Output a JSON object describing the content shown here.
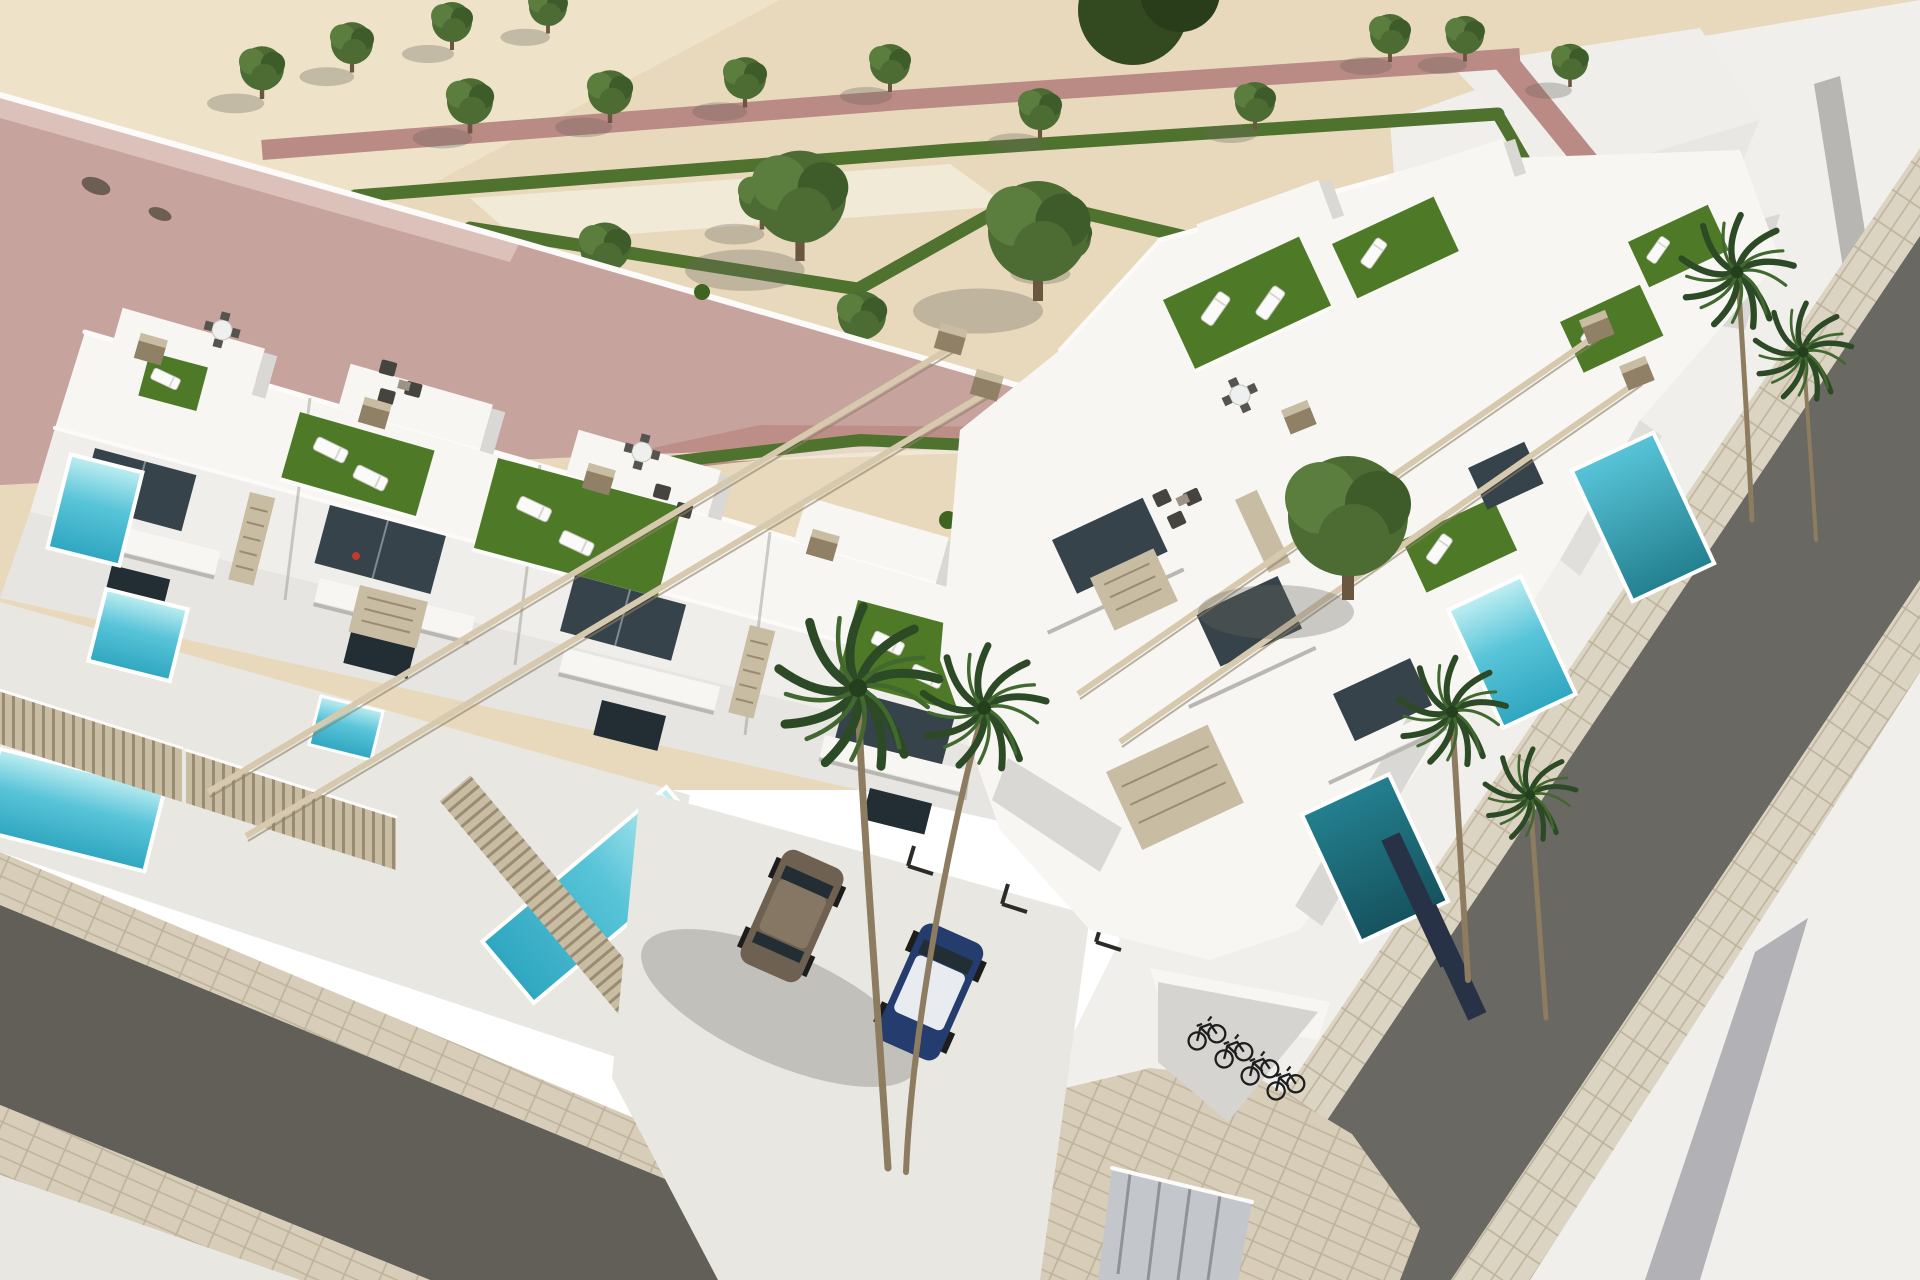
{
  "meta": {
    "type": "architectural-3d-render",
    "title": "Aerial render: modern white townhouse development on a corner plot with park, rooftop terraces and pools"
  },
  "palette": {
    "sand": "#e8d9bc",
    "sandLight": "#f3e9d2",
    "sandPath": "#f2ecdc",
    "plaza": "#f0efec",
    "concrete": "#e9e7e2",
    "roofPink": "#c7a39e",
    "roofPinkLight": "#dcc0ba",
    "pathPink": "#ba8a84",
    "hedge": "#50722f",
    "tree": "#4c6c34",
    "treeLight": "#5b7e3e",
    "treeDark": "#3e5c2a",
    "trunk": "#6b5640",
    "white": "#f7f6f3",
    "whiteDim": "#efeeea",
    "whiteShade": "#e7e5e1",
    "wallShadow": "#d9d8d4",
    "wallDark": "#c9c8c4",
    "parapet": "#fcfbf9",
    "edge": "#8a8984",
    "glass": "#37434a",
    "glassDark": "#232e34",
    "tan": "#c8bca3",
    "tanDark": "#9a8c72",
    "tanDeep": "#8f8066",
    "beam": "#d6c9ae",
    "beamShadow": "#8d8168",
    "turf": "#4e7a28",
    "turfDark": "#3f6420",
    "aquaLight": "#bfeef2",
    "aqua": "#58c4d8",
    "aquaDeep": "#2fa6c0",
    "teal": "#23808f",
    "tealDark": "#16525e",
    "asphalt": "#615f58",
    "asphaltRight": "#6a6862",
    "paver": "#d7cdb9",
    "paverLine": "#bdb29a",
    "stripe": "#a7a6ab",
    "carBronze": "#6e6151",
    "carBronzeTop": "#857764",
    "carBlue": "#243c6e",
    "carRoof": "#e8ecf0",
    "wheel": "#1d1d1d",
    "bike": "#1e1e1e",
    "shed": "#c3c6cb",
    "shedLine": "#8f9298",
    "darkFence": "#273246",
    "loungerFill": "#fafaf8",
    "loungerEdge": "#c6c4bf",
    "sofa": "#45443e",
    "chair": "#55544e",
    "tableTop": "#eef0f0",
    "palmDark": "#2c4a25",
    "palmLight": "#41682f",
    "palmTrunk": "#8d7c60",
    "vent": "#5d5246",
    "shadow": "#6b675c",
    "red": "#c03a2e"
  },
  "scene": {
    "areas": [
      "formal park with zigzag hedges and tree rows",
      "flat pink-roofed building top-left",
      "white townhouse row facing lower-left street",
      "white townhouse cluster facing right street",
      "rooftop terraces with artificial turf, sun loungers, lounge sofas and dining sets",
      "thin pergola rails with tan header blocks",
      "private plunge pools and one long pool",
      "driveway with two parked cars and palm tree",
      "corner bicycle nook and utility shed",
      "asphalt streets with paver sidewalks meeting at corner"
    ],
    "counts": {
      "small_trees": 17,
      "large_trees": 4,
      "palm_canopies": 6,
      "pools": 8,
      "cars": 2,
      "bicycles": 4
    }
  }
}
